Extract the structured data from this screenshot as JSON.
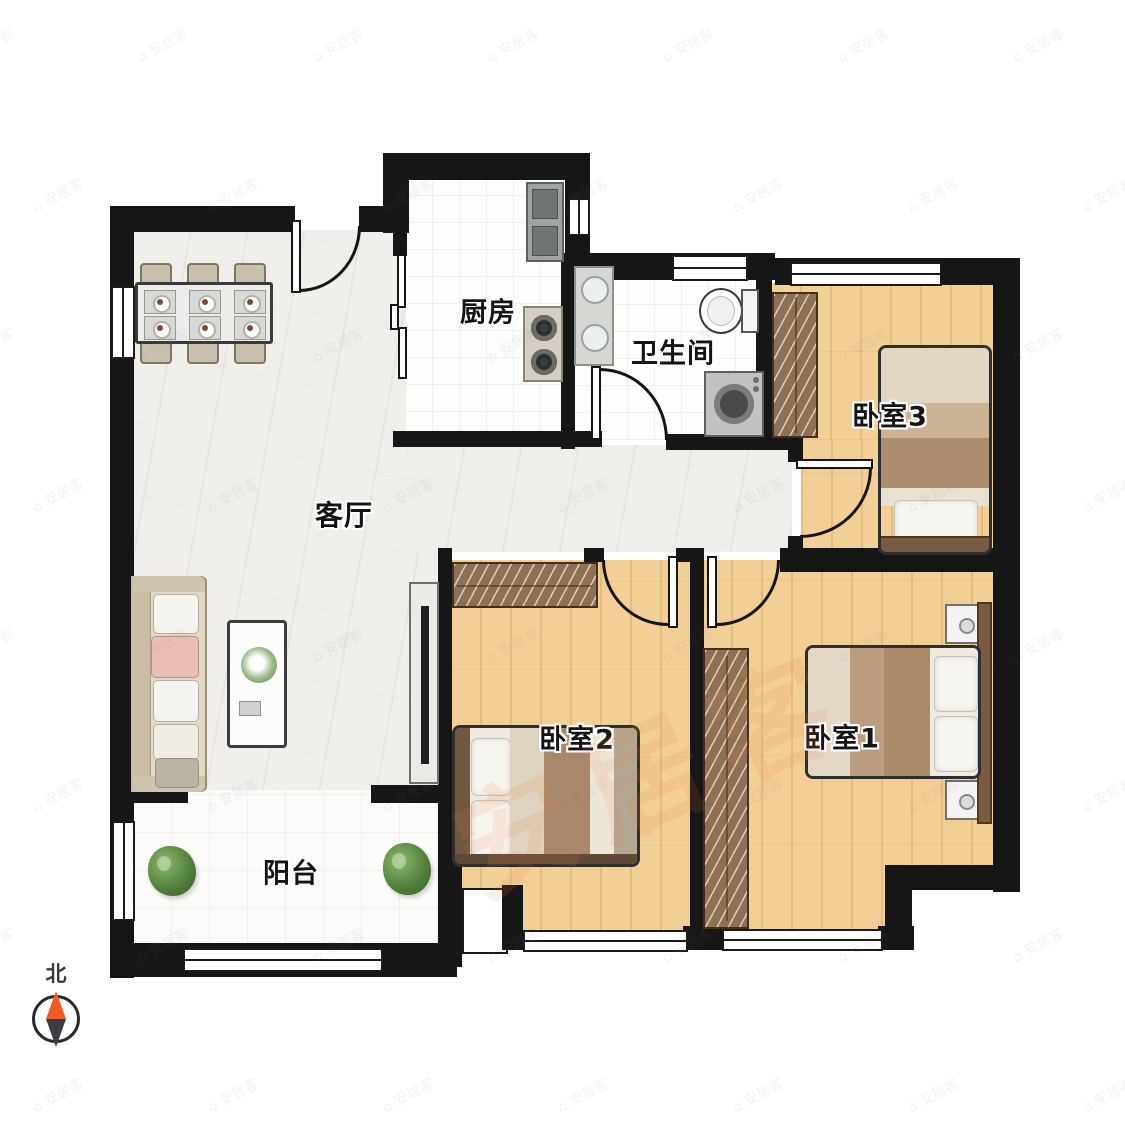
{
  "floorplan": {
    "rooms": [
      {
        "id": "kitchen",
        "label": "厨房"
      },
      {
        "id": "bathroom",
        "label": "卫生间"
      },
      {
        "id": "living",
        "label": "客厅"
      },
      {
        "id": "bedroom3",
        "label": "卧室3"
      },
      {
        "id": "bedroom2",
        "label": "卧室2"
      },
      {
        "id": "bedroom1",
        "label": "卧室1"
      },
      {
        "id": "balcony",
        "label": "阳台"
      }
    ],
    "compass": {
      "label": "北",
      "north_color": "#f15a24",
      "south_color": "#3d3d41"
    },
    "watermark": {
      "text": "安居客",
      "icon": "⌂",
      "tile_color": "#828282",
      "accent_color": "#ec8746"
    },
    "colors": {
      "wall": "#161616",
      "wood_floor": "#f2cf95",
      "marble_floor": "#f1efec",
      "tile_floor": "#fdfdfc",
      "wardrobe": "#8d7157"
    }
  }
}
